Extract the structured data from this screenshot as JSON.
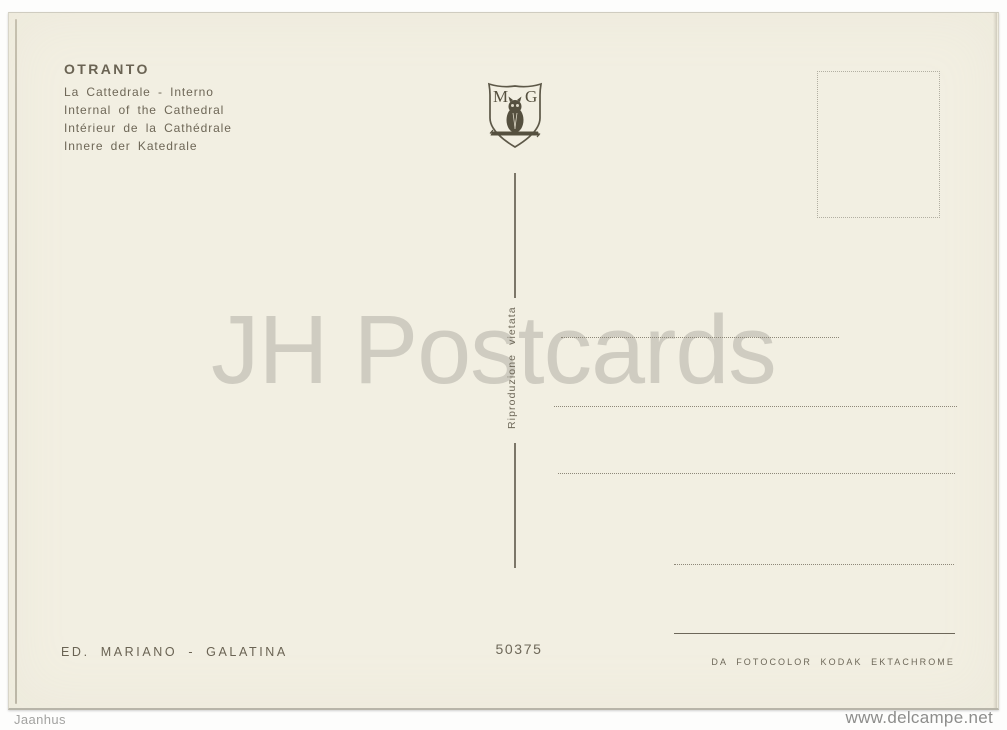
{
  "postcard": {
    "title": "OTRANTO",
    "captions": [
      "La Cattedrale - Interno",
      "Internal of the Cathedral",
      "Intérieur de la Cathédrale",
      "Innere der Katedrale"
    ],
    "crest": {
      "left_initial": "M",
      "right_initial": "G"
    },
    "divider_notice": "Riproduzione vietata",
    "serial_number": "50375",
    "publisher": "ED. MARIANO - GALATINA",
    "film_credit": "DA FOTOCOLOR KODAK EKTACHROME"
  },
  "watermark": "JH Postcards",
  "page_footer": {
    "left": "Jaanhus",
    "right": "www.delcampe.net"
  },
  "colors": {
    "card_background": "#f2efe2",
    "ink": "#6a6353",
    "watermark_gray": "#c9c8c3",
    "page_background": "#fdfdfc"
  }
}
